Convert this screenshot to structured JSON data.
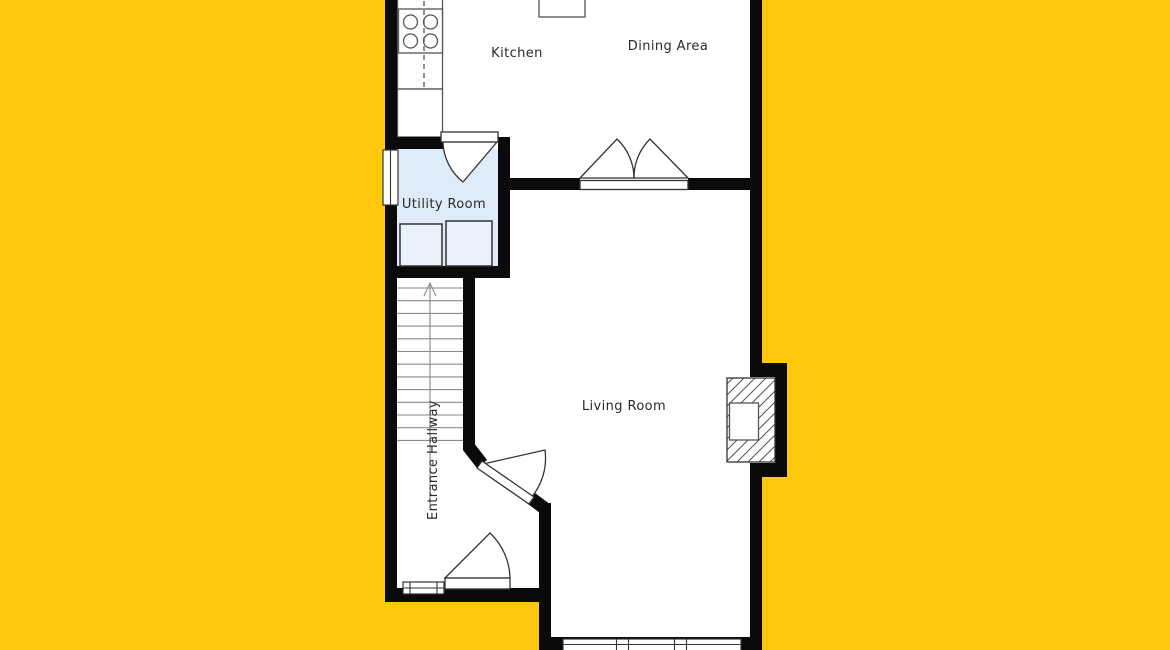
{
  "rooms": {
    "kitchen": "Kitchen",
    "dining": "Dining Area",
    "utility": "Utility Room",
    "living": "Living Room",
    "hallway": "Entrance Hallway"
  },
  "fixtures": [
    "cooktop-stove",
    "kitchen-counter",
    "dining-table",
    "double-door",
    "utility-door",
    "washer",
    "dryer",
    "utility-window",
    "staircase",
    "stairs-direction-arrow",
    "interior-door",
    "front-door",
    "entry-window",
    "fireplace",
    "bay-window"
  ],
  "colors": {
    "bg": "#ffc80d",
    "wall": "#0a0a0a",
    "floor": "#ffffff",
    "utility": "#ddecf8",
    "line": "#555555",
    "doorline": "#333333",
    "stairline": "#8a8a8a",
    "appliance": "#e9f2fa",
    "label": "#2a2a2a"
  }
}
